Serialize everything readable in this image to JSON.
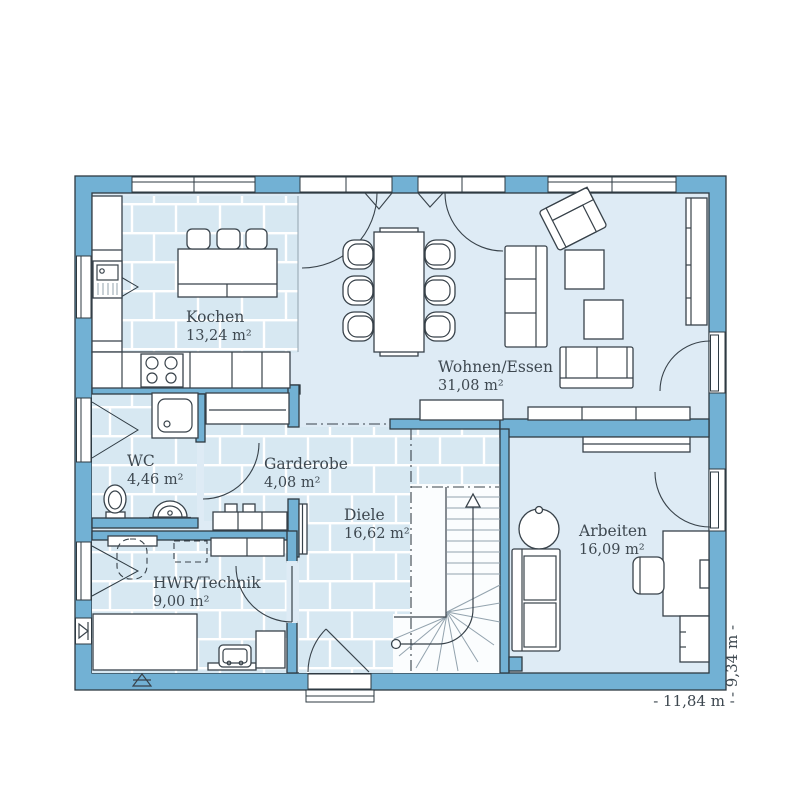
{
  "plan": {
    "title": "floor-plan-ground-floor",
    "rooms": [
      {
        "name": "Kochen",
        "area": "13,24 m²"
      },
      {
        "name": "Wohnen/Essen",
        "area": "31,08 m²"
      },
      {
        "name": "WC",
        "area": "4,46 m²"
      },
      {
        "name": "Garderobe",
        "area": "4,08 m²"
      },
      {
        "name": "Diele",
        "area": "16,62 m²"
      },
      {
        "name": "HWR/Technik",
        "area": "9,00 m²"
      },
      {
        "name": "Arbeiten",
        "area": "16,09 m²"
      }
    ],
    "dimensions": {
      "width_label": "- 11,84 m -",
      "height_label": "- 9,34 m -"
    },
    "colors": {
      "wall": "#72B1D4",
      "floor": "#DEEBF5",
      "tile_floor": "#D7E8F2",
      "tile_grout": "#FFFFFF",
      "outline": "#2E3A42",
      "furniture_line": "#38424A",
      "label_text": "#3E4850"
    }
  }
}
